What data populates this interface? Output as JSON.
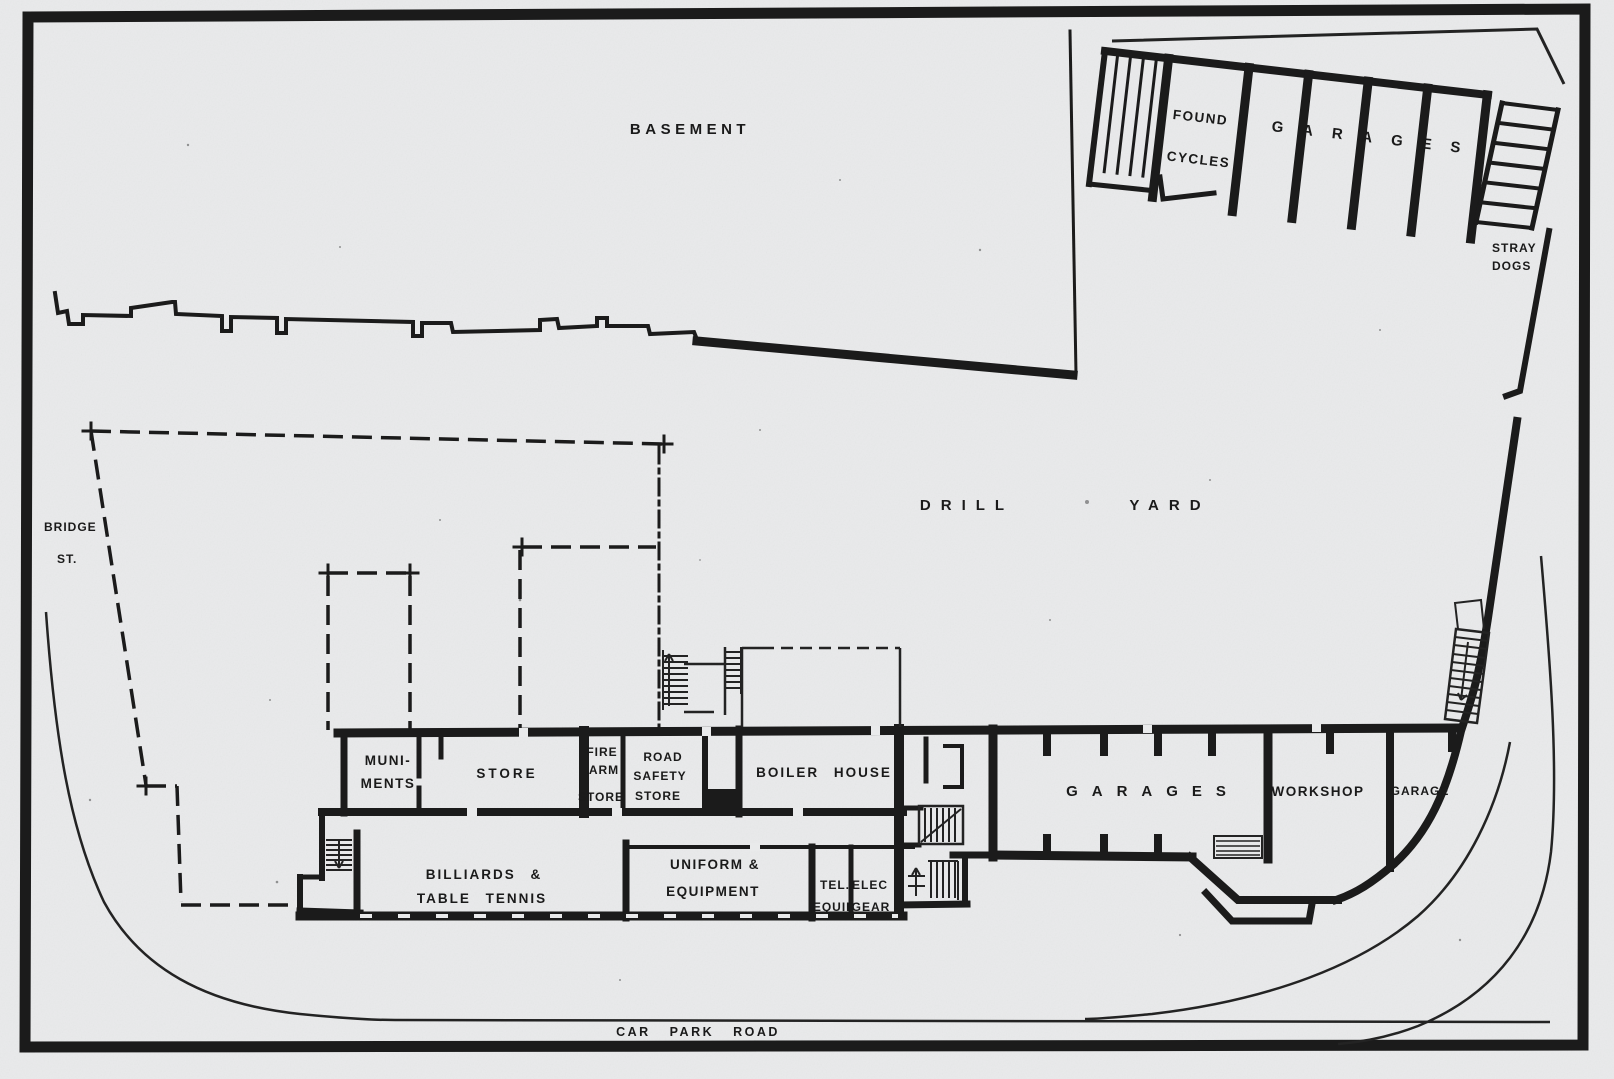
{
  "colors": {
    "paper": "#e9eaeb",
    "ink": "#1a1a1a"
  },
  "labels": {
    "basement": "BASEMENT",
    "drill": "DRILL",
    "yard": "YARD",
    "bridge": "BRIDGE",
    "st": "ST.",
    "car_park_road": "CAR PARK ROAD",
    "found": "FOUND",
    "cycles": "CYCLES",
    "garages_top": "GARAGES",
    "stray": "STRAY",
    "dogs": "DOGS",
    "muniments_1": "MUNI-",
    "muniments_2": "MENTS",
    "store": "STORE",
    "firearm_1": "FIRE",
    "firearm_2": "ARM",
    "firearm_3": "STORE",
    "roadsafety_1": "ROAD",
    "roadsafety_2": "SAFETY",
    "roadsafety_3": "STORE",
    "boiler_house": "BOILER HOUSE",
    "billiards_1": "BILLIARDS &",
    "billiards_2": "TABLE TENNIS",
    "uniform_1": "UNIFORM &",
    "uniform_2": "EQUIPMENT",
    "tel": "TEL.",
    "elec": "ELEC",
    "equip": "EQUIP",
    "gear": "GEAR",
    "garages_main": "GARAGES",
    "workshop": "WORKSHOP",
    "garage": "GARAGE"
  }
}
